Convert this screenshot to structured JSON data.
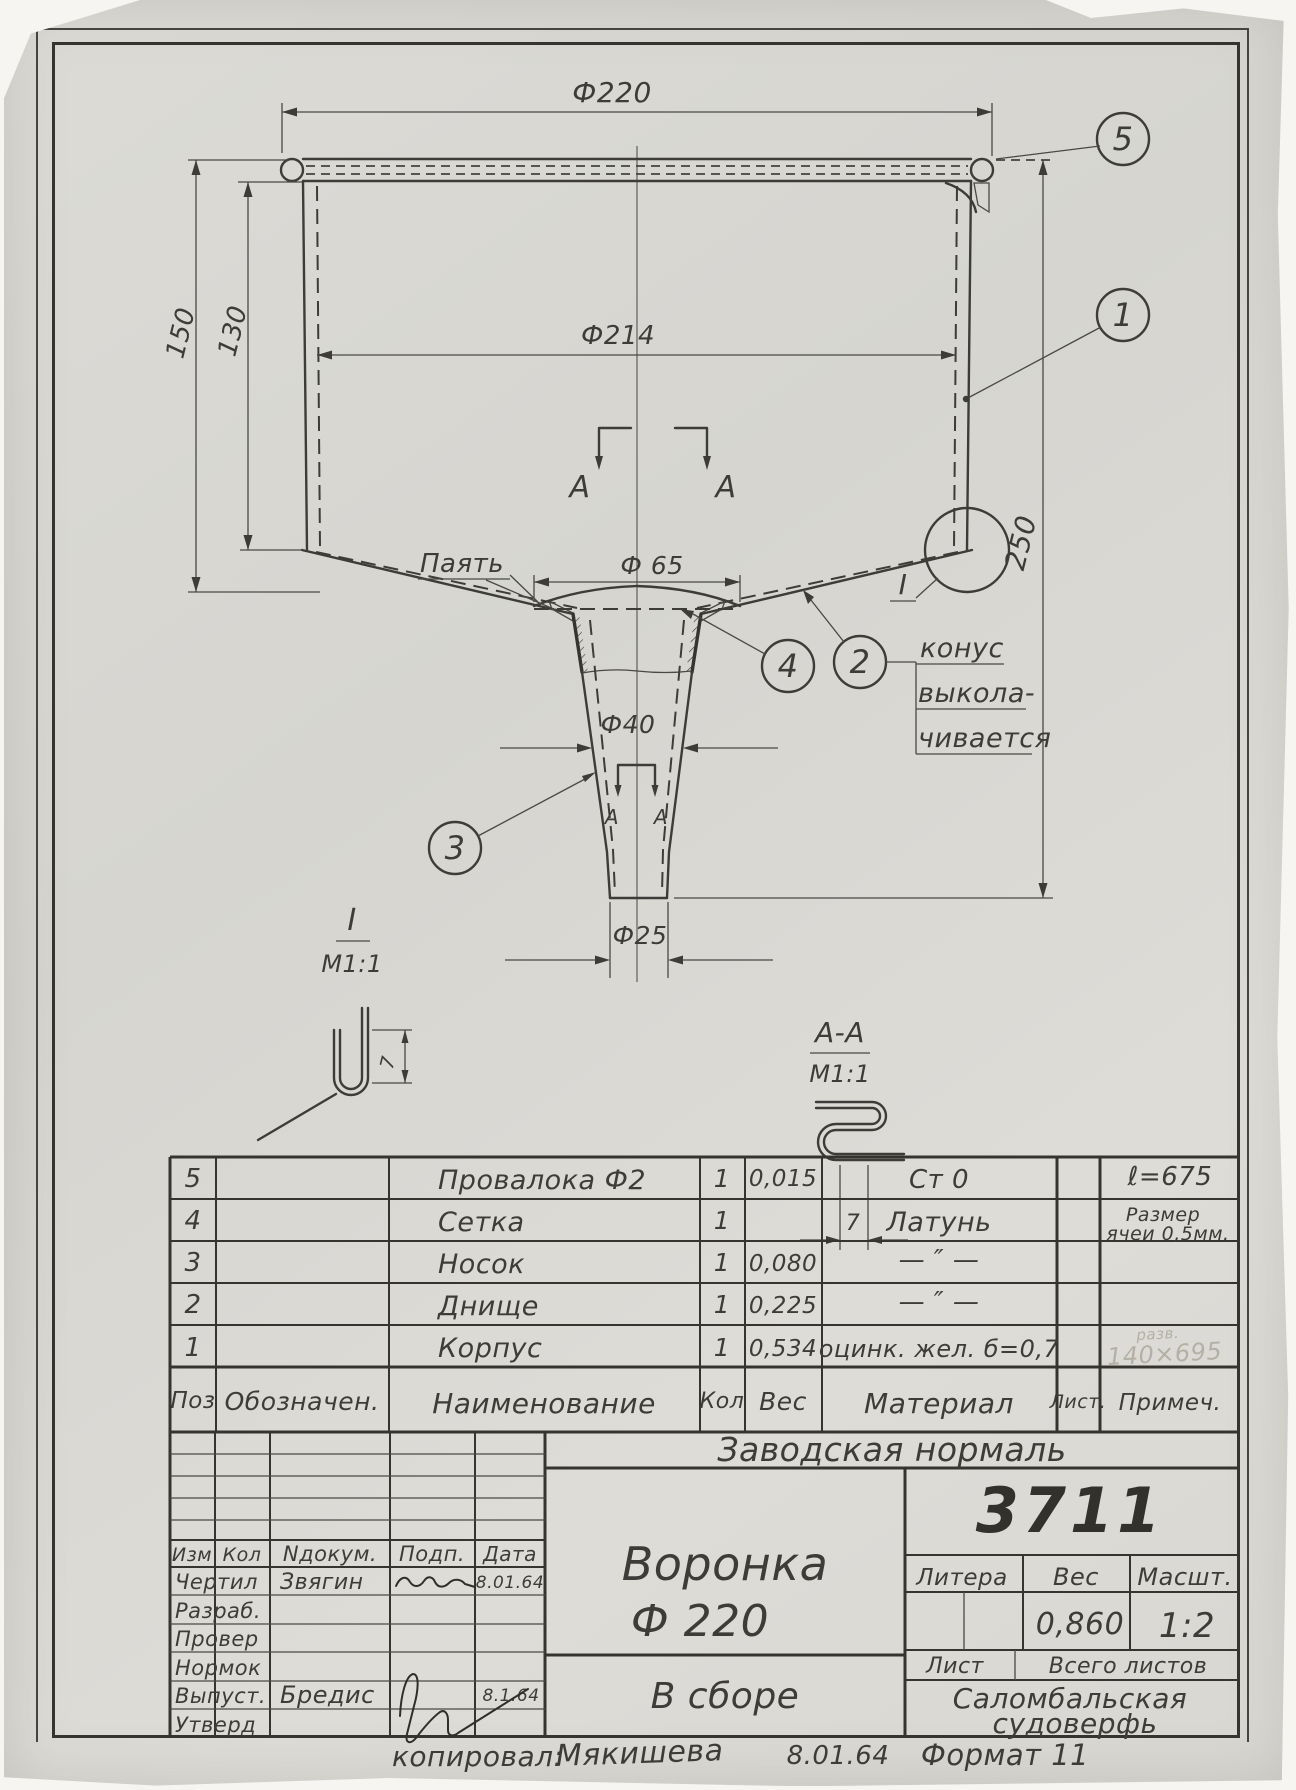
{
  "colors": {
    "ink": "#3d3c38",
    "paper": "#dad9d4",
    "pencil": "#b4b0a5"
  },
  "drawing": {
    "dims": {
      "d220": "Ф220",
      "d214": "Ф214",
      "d65": "Ф 65",
      "d40": "Ф40",
      "d25": "Ф25",
      "h150": "150",
      "h130": "130",
      "h250": "250",
      "w7": "7"
    },
    "notes": {
      "solder": "Паять",
      "cone1": "конус",
      "cone2": "выкола-",
      "cone3": "чивается"
    },
    "sections": {
      "letter": "А",
      "cut_label": "А-А",
      "scale": "М1:1"
    },
    "details": {
      "label": "I",
      "scale": "М1:1"
    },
    "callouts": {
      "c1": "1",
      "c2": "2",
      "c3": "3",
      "c4": "4",
      "c5": "5"
    }
  },
  "parts_table": {
    "headers": {
      "pos": "Поз",
      "designation": "Обозначен.",
      "name": "Наименование",
      "qty": "Кол",
      "weight": "Вес",
      "material": "Материал",
      "sheet": "Лист.",
      "note": "Примеч."
    },
    "rows": [
      {
        "pos": "5",
        "name": "Провалока Ф2",
        "qty": "1",
        "weight": "0,015",
        "material": "Ст 0",
        "note": "ℓ=675",
        "note2": ""
      },
      {
        "pos": "4",
        "name": "Сетка",
        "qty": "1",
        "weight": "",
        "material": "Латунь",
        "note": "Размер",
        "note2": "ячеи 0,5мм."
      },
      {
        "pos": "3",
        "name": "Носок",
        "qty": "1",
        "weight": "0,080",
        "material": "— ″ —",
        "note": "",
        "note2": ""
      },
      {
        "pos": "2",
        "name": "Днище",
        "qty": "1",
        "weight": "0,225",
        "material": "— ″ —",
        "note": "",
        "note2": ""
      },
      {
        "pos": "1",
        "name": "Корпус",
        "qty": "1",
        "weight": "0,534",
        "material": "оцинк. жел. б=0,7",
        "note": "",
        "note2": ""
      }
    ],
    "pencil_note": {
      "line1": "разв.",
      "line2": "140×695"
    }
  },
  "title_block": {
    "standard": "Заводская нормаль",
    "number": "3711",
    "product": "Воронка",
    "diameter": "Ф 220",
    "state": "В сборе",
    "litera": "Литера",
    "weight_label": "Вес",
    "scale_label": "Масшт.",
    "weight": "0,860",
    "scale": "1:2",
    "sheet_label": "Лист",
    "sheets_total_label": "Всего листов",
    "org1": "Саломбальская",
    "org2": "судоверфь",
    "columns": {
      "izm": "Изм",
      "kol": "Кол",
      "doc": "Nдокум.",
      "sign": "Подп.",
      "date": "Дата"
    },
    "rows": [
      {
        "role": "Чертил",
        "name": "Звягин",
        "date": "8.01.64"
      },
      {
        "role": "Разраб.",
        "name": "",
        "date": ""
      },
      {
        "role": "Провер",
        "name": "",
        "date": ""
      },
      {
        "role": "Нормок",
        "name": "",
        "date": ""
      },
      {
        "role": "Выпуст.",
        "name": "Бредис",
        "date": "8.1.64"
      },
      {
        "role": "Утверд",
        "name": "",
        "date": ""
      }
    ]
  },
  "footer": {
    "copied": "копировал:",
    "sig": "Мякишева",
    "date": "8.01.64",
    "format": "Формат 11"
  }
}
